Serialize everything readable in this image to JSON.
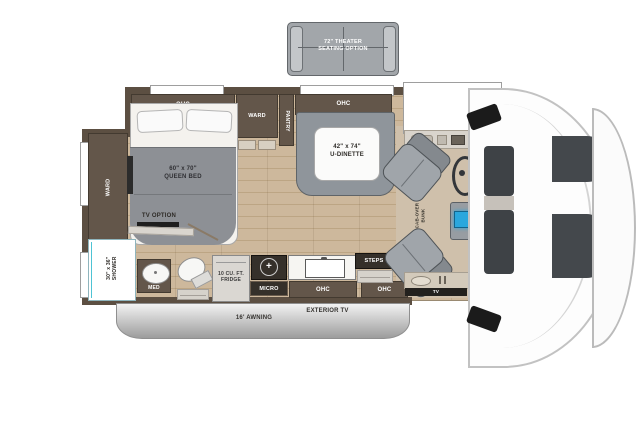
{
  "labels": {
    "theater_sofa": "72\" THEATER\nSEATING OPTION",
    "ohc": "OHC",
    "ward": "WARD",
    "pantry": "PANTRY",
    "queen_bed": "60\" x 70\"\nQUEEN BED",
    "tv_option": "TV OPTION",
    "shower": "30\" x 36\"\nSHOWER",
    "med": "MED",
    "fridge": "10 CU. FT.\nFRIDGE",
    "micro": "MICRO",
    "steps": "STEPS",
    "dinette": "42\" x 74\"\nU-DINETTE",
    "cab_over_bunk": "CAB-OVER\nBUNK",
    "cab_tv": "TV",
    "awning": "16' AWNING",
    "exterior_tv": "EXTERIOR TV",
    "stove_burner": "+"
  },
  "colors": {
    "wall": "#5c4f42",
    "cabinet": "#63564a",
    "floor": "#c9b499",
    "seat_gray": "#9aa0a5",
    "shower_teal": "#4ec3d4",
    "console_screen": "#2aa7dd"
  }
}
